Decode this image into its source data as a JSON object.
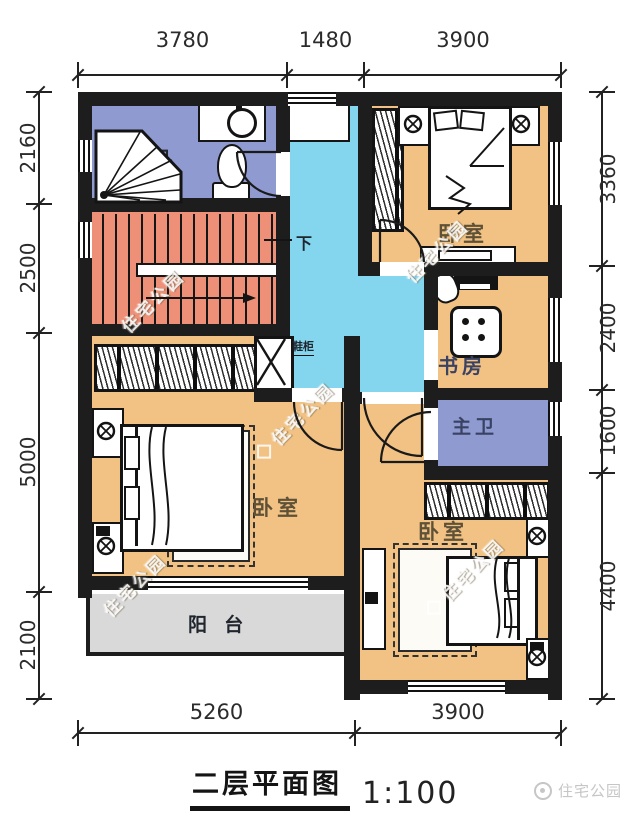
{
  "title": {
    "name": "二层平面图",
    "scale": "1:100"
  },
  "brand": {
    "watermark": "住宅公园",
    "logo": "住宅公园"
  },
  "dimensions": {
    "top": [
      "3780",
      "1480",
      "3900"
    ],
    "bottom": [
      "5260",
      "3900"
    ],
    "left": [
      "2160",
      "2500",
      "5000",
      "2100"
    ],
    "right": [
      "3360",
      "2400",
      "1600",
      "4400"
    ]
  },
  "rooms": {
    "bathroom": "卫",
    "bedroom_top_right": "卧室",
    "study": "书房",
    "master_bathroom": "主卫",
    "bedroom_bottom_left": "卧室",
    "bedroom_bottom_right": "卧室",
    "balcony": "阳 台",
    "stairs_down": "下",
    "shoe_cabinet": "鞋柜"
  },
  "colors": {
    "wall": "#1d1d1d",
    "bedroom_fill": "#f1c283",
    "bathroom_fill": "#8e9ad0",
    "stairs_fill": "#ed9077",
    "hall_fill": "#84d5ee",
    "balcony_fill": "#d9d9d9",
    "label_dark": "#20262e",
    "label_brown": "#5e5138",
    "label_navy": "#3a4263",
    "dim_text": "#2b2b2b",
    "logo_gray": "#c6c6c6"
  },
  "icons": {
    "shower-icon": "corner shower pan with spray lines",
    "toilet-icon": "toilet bowl with tank",
    "basin-icon": "round wash basin",
    "lamp-icon": "bedside lamp circle",
    "stairs-arrow-icon": "stair direction arrow",
    "shoe-cabinet-icon": "crossed box",
    "logo-icon": "brand circle mark"
  }
}
